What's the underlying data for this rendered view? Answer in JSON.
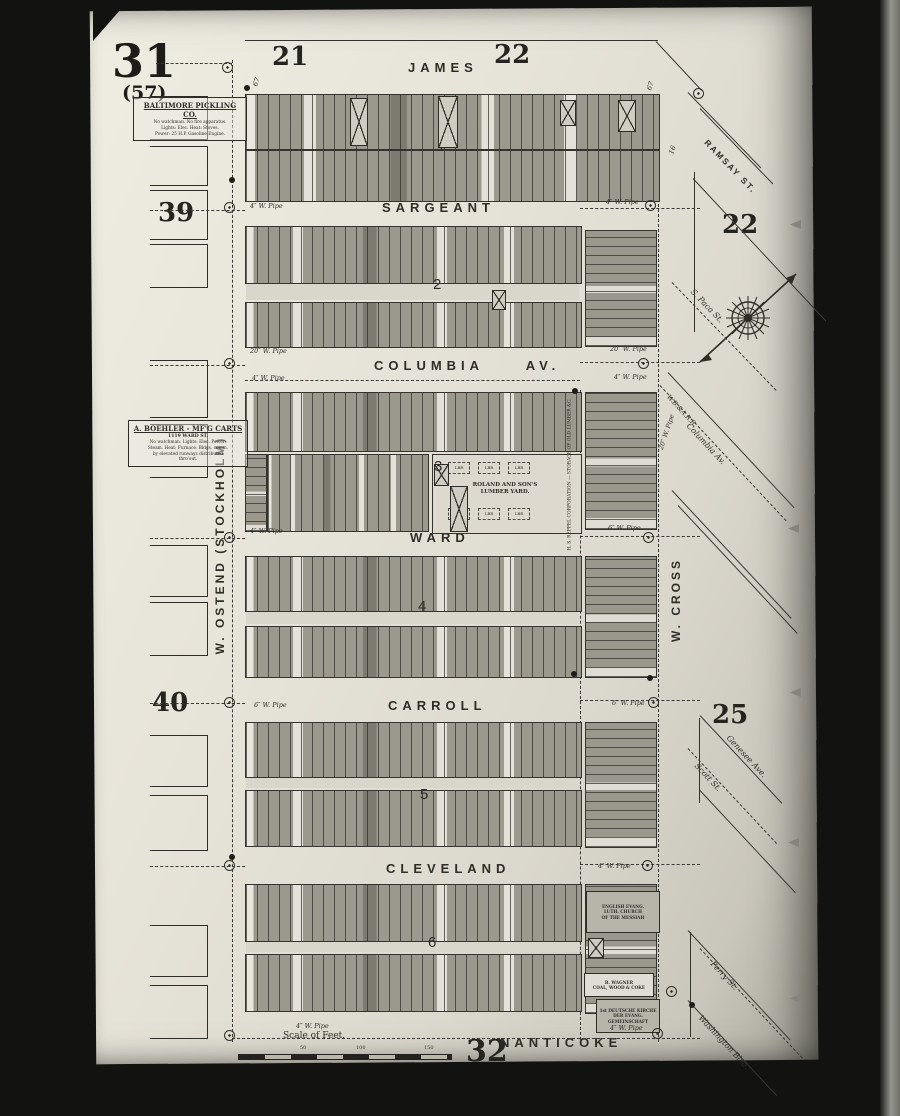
{
  "sheet": {
    "number": "31",
    "alt_number": "(57)",
    "bottom_number": "32",
    "scale_label": "Scale of Feet.",
    "scale_ticks": [
      "50",
      "100",
      "150"
    ]
  },
  "corner_blocks": {
    "top_left": "21",
    "top_right": "22",
    "left_upper": "39",
    "left_lower": "40",
    "right_upper": "22",
    "right_lower": "25"
  },
  "streets": {
    "horizontal": [
      "JAMES",
      "SARGEANT",
      "COLUMBIA AV.",
      "WARD",
      "CARROLL",
      "CLEVELAND",
      "NANTICOKE"
    ],
    "vertical_left": "W. OSTEND  (STOCKHOLM)",
    "vertical_right": "W. CROSS",
    "diagonal": [
      "RAMSAY ST.",
      "S. Paca St.",
      "W.B.&A.R.R.",
      "Columbia Av.",
      "Genesee Ave.",
      "Scott St.",
      "Perry St.",
      "Washington Blvd."
    ]
  },
  "blocks": {
    "numbers": [
      "1",
      "2",
      "3",
      "4",
      "5",
      "6"
    ]
  },
  "notes": {
    "pickling": {
      "title": "BALTIMORE PICKLING CO.",
      "lines": "No watchman. No fire apparatus.\nLights: Elec. Heat: Stoves.\nPower: 25 H.P. Gasoline Engine."
    },
    "carts": {
      "title": "A. BOEHLER - MF'G CARTS",
      "sub": "1119 WARD ST.",
      "lines": "No watchman. Lights: Elec. Power:\nSteam. Heat: Furnace. Bldgs. comm.\nby elevated runways distributed\nthro'out."
    }
  },
  "features": {
    "lumber_yard": "ROLAND AND SON'S\nLUMBER YARD.",
    "lumber_storage": "H. S. REPPEL CORPORATION — STORAGE OF OLD LUMBER &C.",
    "church1": "ENGLISH EVANG.\nLUTH. CHURCH\nOF THE MESSIAH",
    "coal_yard": "B. WAGNER\nCOAL, WOOD & COKE",
    "church2": "1st DEUTSCHE KIRCHE\nDER EVANG.\nGEMEINSCHAFT",
    "lbr": "LBR"
  },
  "pipes": [
    "6″ W. Pipe",
    "4″ W. Pipe",
    "4″ W. Pipe",
    "20″ W. Pipe",
    "4″ W. Pipe",
    "20″ W. Pipe",
    "4″ W. Pipe",
    "4″ W. Pipe",
    "6″ W. Pipe",
    "6″ W. Pipe",
    "6″ W. Pipe",
    "4″ W. Pipe",
    "4″ W. Pipe",
    "4″ W. Pipe",
    "20″ W. Pipe"
  ],
  "street_widths": [
    "67",
    "67",
    "16"
  ]
}
